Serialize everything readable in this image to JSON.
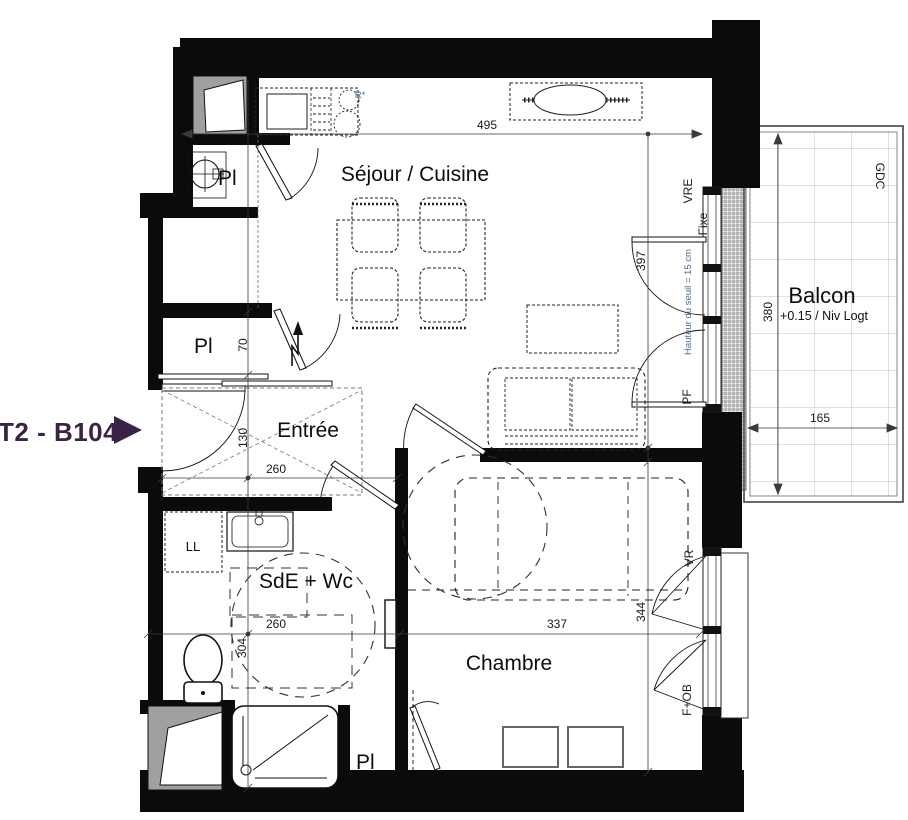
{
  "unit": {
    "label": "T2 - B104"
  },
  "colors": {
    "unit_label": "#3b2348",
    "annotation_blue": "#4a6b8a",
    "walls": "#0b0b0b",
    "duct_fill": "#a0a0a0",
    "balcony_grid": "#c2c2c2",
    "dim_line": "#3a3a3a"
  },
  "rooms": {
    "sejour": "Séjour / Cuisine",
    "entree": "Entrée",
    "sde": "SdE + Wc",
    "chambre": "Chambre",
    "balcon": "Balcon",
    "balcon_level": "+0.15 / Niv Logt"
  },
  "closets": {
    "top": "Pl",
    "middle": "Pl",
    "bottom": "Pl"
  },
  "appliances": {
    "ll_label": "LL",
    "r_label": "R*"
  },
  "openings": {
    "vre": "VRE",
    "fixe": "Fixe",
    "pf": "PF",
    "vr": "VR",
    "f_ob": "F+OB",
    "gdc": "GDC",
    "seuil_note": "Hauteur du seuil = 15 cm"
  },
  "dimensions": {
    "sejour_width": "495",
    "sejour_window_height": "397",
    "balcon_depth": "380",
    "balcon_width": "165",
    "closet_depth": "70",
    "entree_depth": "130",
    "entree_width": "260",
    "sde_width": "260",
    "sde_depth": "304",
    "chambre_width": "337",
    "chambre_depth": "344"
  }
}
